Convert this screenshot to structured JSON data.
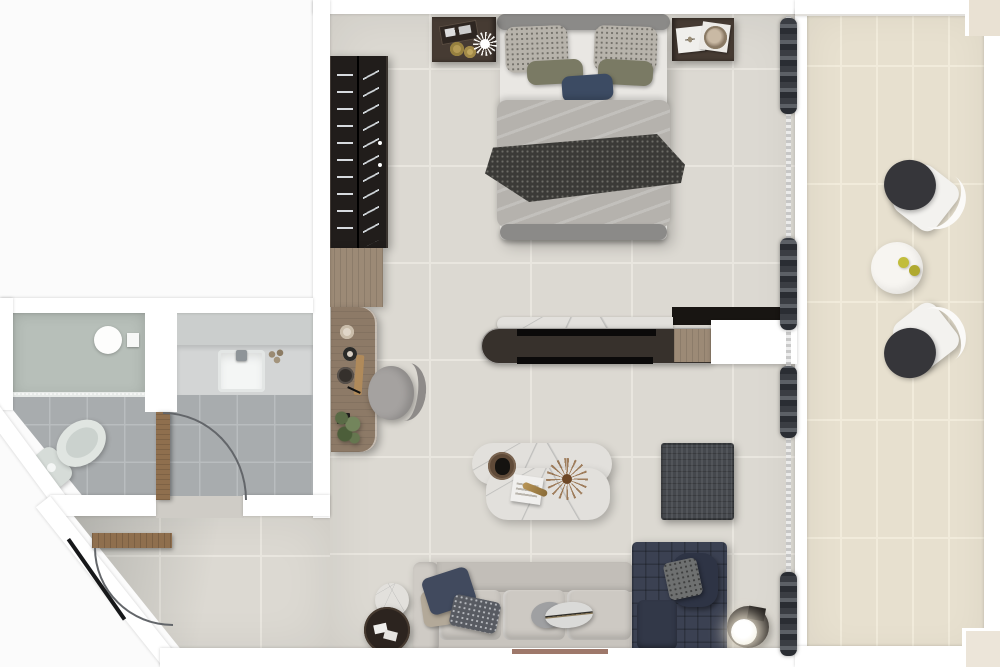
{
  "scene": {
    "kind": "apartment-floor-plan-3d-render",
    "view": "top-down",
    "rooms": {
      "bedroom": {
        "furniture": [
          "double-bed",
          "headboard",
          "nightstand-left",
          "nightstand-right",
          "wardrobe",
          "desk",
          "desk-chair",
          "desk-plant"
        ]
      },
      "living-room": {
        "furniture": [
          "media-console-divider",
          "coffee-table",
          "floor-rug-pouf",
          "sofa",
          "chaise-lounge",
          "nesting-side-tables",
          "lamp-side-table",
          "sphere-lamp"
        ]
      },
      "bathroom": {
        "furniture": [
          "walk-in-shower",
          "rain-shower-head",
          "vanity-counter",
          "sink",
          "toilet",
          "bathroom-door"
        ]
      },
      "entry-hall": {
        "furniture": [
          "entry-door"
        ]
      },
      "balcony": {
        "furniture": [
          "outdoor-chair-top",
          "outdoor-chair-bottom",
          "round-outdoor-table",
          "lemons"
        ]
      }
    },
    "decor": [
      "bed-pillows",
      "olive-pillows",
      "navy-accent-pillow",
      "throw-blanket",
      "books",
      "round-mirror-tray",
      "spiky-ornament",
      "gold-coasters",
      "dried-plant",
      "serving-tray",
      "window-sheer-curtain",
      "drape-bunches"
    ]
  },
  "palette": {
    "background": "#fbfbfb",
    "wall": "#ffffff",
    "floor_main": "#dcd9d2",
    "floor_line": "#e9e6df",
    "floor_bath": "#a8acae",
    "bath_line": "#b9bdbf",
    "floor_balcony": "#e7e0cf",
    "balcony_line": "#f1ebdb",
    "shower_glass": "#b7bfb9",
    "vanity": "#d3d5d5",
    "sink": "#f4f6f5",
    "toilet": "#d6dcd8",
    "wood_door": "#8f6f4e",
    "wood_desk": "#8d7a67",
    "wood_cabinet": "#9c8a76",
    "wardrobe": "#211d1b",
    "nightstand": "#463b33",
    "console": "#37312c",
    "console_strip": "#0b0a0a",
    "band_dark": "#181512",
    "marble": "#e2e0dc",
    "marble_vein": "#b9b9b7",
    "headboard": "#8b8a88",
    "bed_sheet": "#e9e7e3",
    "duvet": "#b5b2ad",
    "pillow_speckle": "#b7b3ab",
    "pillow_olive": "#7a7a64",
    "pillow_navy": "#3c4b63",
    "throw": "#3b3a37",
    "sofa": "#c8c4be",
    "sofa_cushion": "#cdc9c3",
    "chaise": "#3b4152",
    "chaise_dark": "#2e3445",
    "rug": "#45484d",
    "curtain": "#2a2d33",
    "sheer": "#d9d9d9",
    "chair_white": "#f3f2ef",
    "chair_cushion": "#36363a",
    "table_white": "#f7f5f1",
    "lemon": "#c2bd3c",
    "lamp_glow": "#fff6e0",
    "table_dark": "#2c241f",
    "plant": "#5f7247",
    "rust": "#7d4b38"
  }
}
